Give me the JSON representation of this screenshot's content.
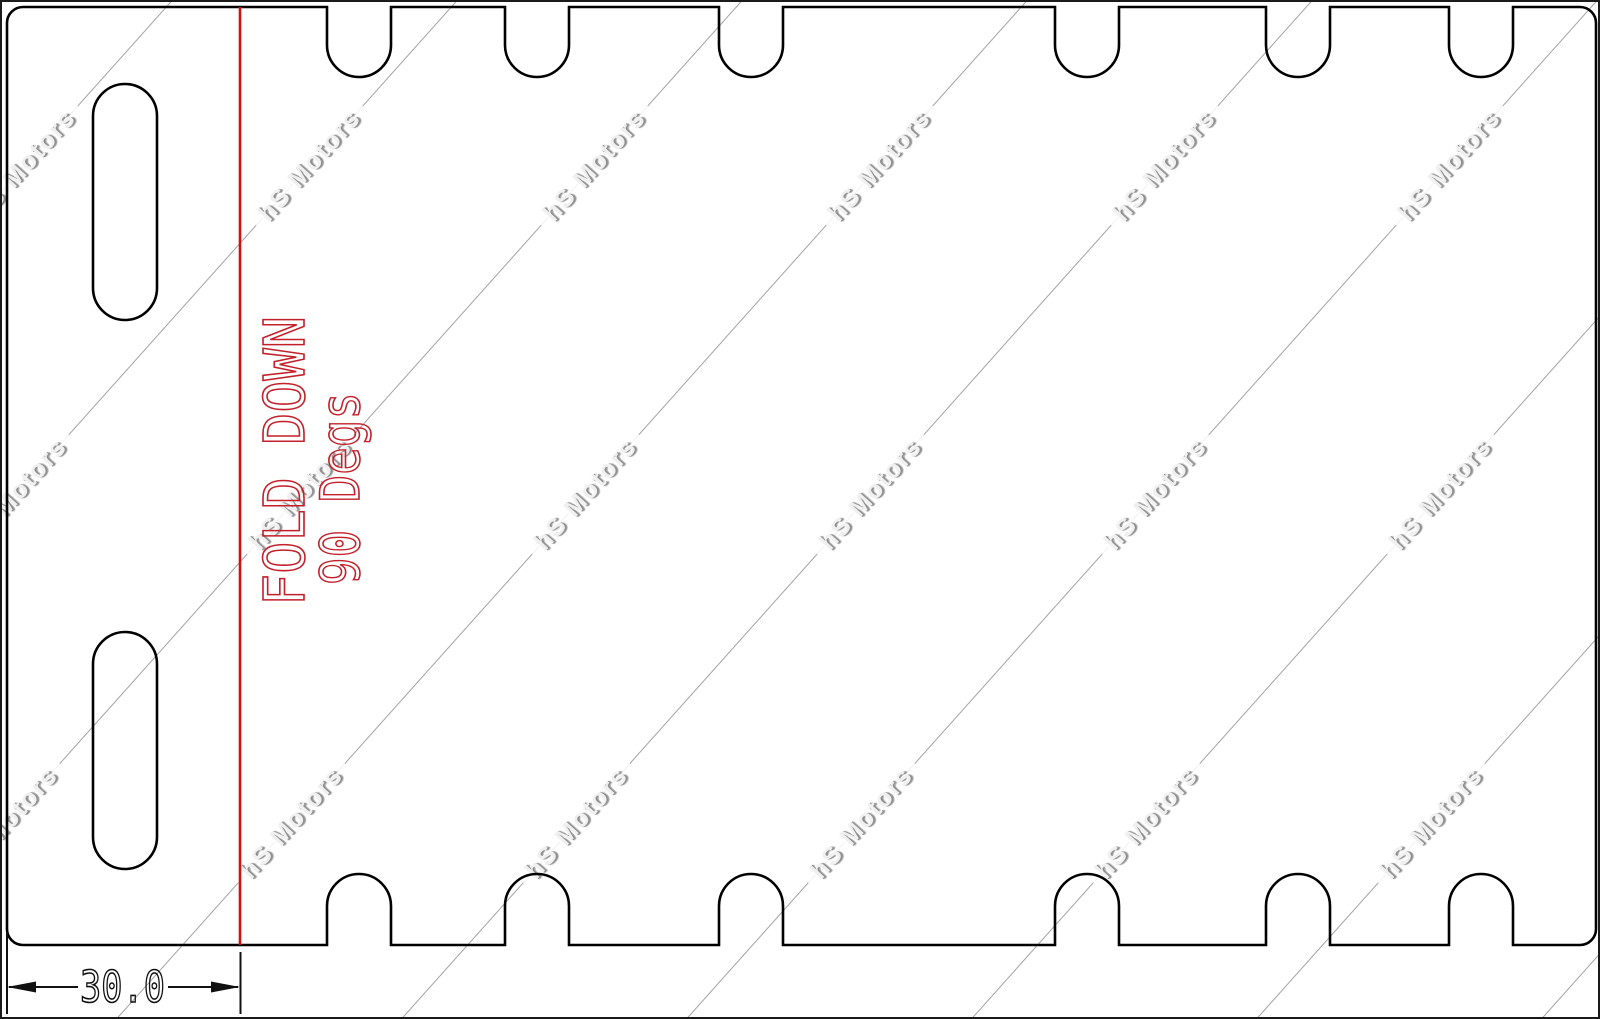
{
  "drawing": {
    "fold_note_line1": "FOLD DOWN",
    "fold_note_line2": "90 Degs",
    "dimension_value": "30.0"
  },
  "watermark": {
    "text": "hS Motors"
  },
  "colors": {
    "outline": "#000000",
    "fold_line": "#c41414",
    "note_text": "#c2202a",
    "dimension": "#111111",
    "watermark_line": "#a3a3a3",
    "watermark_text_fill": "#f0f0f0",
    "watermark_text_shadow": "#8d8d8d"
  }
}
